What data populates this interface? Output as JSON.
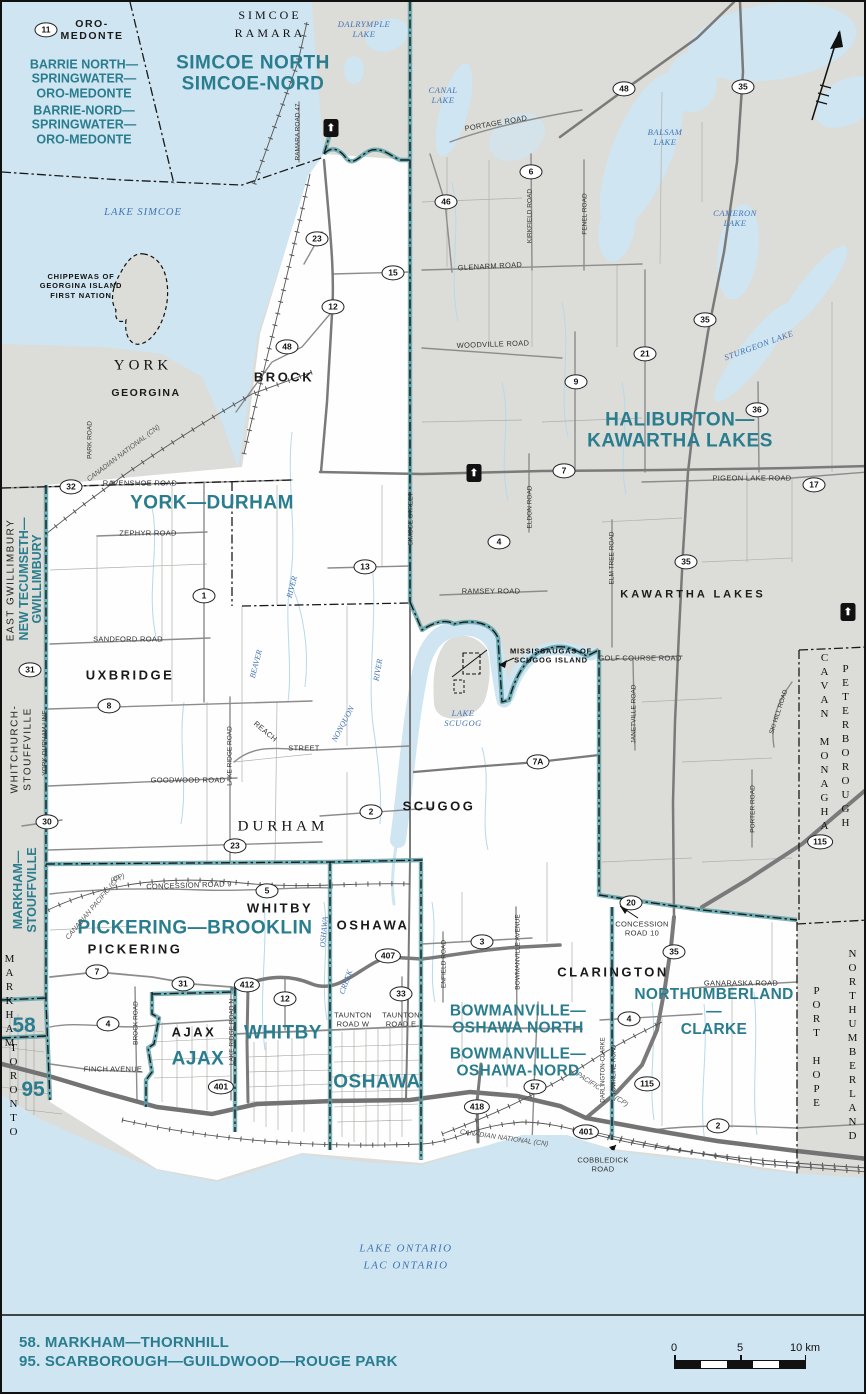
{
  "map": {
    "colors": {
      "water": "#cfe5f1",
      "other_district_gray": "#dcdcd8",
      "featured_white": "#fefefe",
      "riding_teal_text": "#2a7d8e",
      "boundary_teal": "#56a0a7",
      "water_label_blue": "#4273b3",
      "road_gray": "#8c8c8c",
      "boundary_black": "#1a1a1a"
    },
    "legend": {
      "items": [
        "58. MARKHAM—THORNHILL",
        "95. SCARBOROUGH—GUILDWOOD—ROUGE PARK"
      ]
    },
    "scale_bar": {
      "ticks": [
        "0",
        "5",
        "10 km"
      ]
    },
    "highway_marker_glyph": "⬆",
    "labels": [
      {
        "t": "ORO-\nMEDONTE",
        "x": 90,
        "y": 28,
        "c": "muni-sm"
      },
      {
        "t": "SIMCOE",
        "x": 268,
        "y": 14,
        "c": "serif-sm"
      },
      {
        "t": "RAMARA",
        "x": 268,
        "y": 32,
        "c": "serif-sm"
      },
      {
        "t": "BARRIE NORTH—\nSPRINGWATER—\nORO-MEDONTE",
        "x": 82,
        "y": 77,
        "c": "r3",
        "name": "riding-label-barrie-north-springwater-oro-medonte"
      },
      {
        "t": "BARRIE-NORD—\nSPRINGWATER—\nORO-MEDONTE",
        "x": 82,
        "y": 123,
        "c": "r3",
        "name": "riding-label-barrie-nord-springwater-oro-medonte"
      },
      {
        "t": "SIMCOE NORTH\nSIMCOE-NORD",
        "x": 251,
        "y": 72,
        "c": "r1",
        "name": "riding-label-simcoe-north"
      },
      {
        "t": "LAKE SIMCOE",
        "x": 141,
        "y": 211,
        "c": "water"
      },
      {
        "t": "DALRYMPLE\nLAKE",
        "x": 362,
        "y": 28,
        "c": "water-sm"
      },
      {
        "t": "CANAL\nLAKE",
        "x": 441,
        "y": 94,
        "c": "water-sm"
      },
      {
        "t": "BALSAM\nLAKE",
        "x": 663,
        "y": 136,
        "c": "water-sm"
      },
      {
        "t": "CAMERON\nLAKE",
        "x": 733,
        "y": 217,
        "c": "water-sm"
      },
      {
        "t": "STURGEON LAKE",
        "x": 757,
        "y": 344,
        "c": "water-sm",
        "r": -20
      },
      {
        "t": "CHIPPEWAS OF\nGEORGINA ISLAND\nFIRST NATION",
        "x": 79,
        "y": 284,
        "c": "fn",
        "name": "first-nation-label-chippewas"
      },
      {
        "t": "YORK",
        "x": 141,
        "y": 364,
        "c": "serif"
      },
      {
        "t": "GEORGINA",
        "x": 144,
        "y": 391,
        "c": "muni-sm"
      },
      {
        "t": "BROCK",
        "x": 282,
        "y": 376,
        "c": "muni"
      },
      {
        "t": "HALIBURTON—KAWARTHA LAKES",
        "x": 678,
        "y": 429,
        "c": "r1",
        "name": "riding-label-haliburton-kawartha-lakes"
      },
      {
        "t": "YORK—DURHAM",
        "x": 210,
        "y": 502,
        "c": "r1",
        "name": "riding-label-york-durham"
      },
      {
        "t": "KAWARTHA LAKES",
        "x": 691,
        "y": 593,
        "c": "muni-sp"
      },
      {
        "t": "UXBRIDGE",
        "x": 128,
        "y": 674,
        "c": "muni"
      },
      {
        "t": "DURHAM",
        "x": 281,
        "y": 825,
        "c": "serif"
      },
      {
        "t": "SCUGOG",
        "x": 437,
        "y": 805,
        "c": "muni"
      },
      {
        "t": "LAKE\nSCUGOG",
        "x": 461,
        "y": 717,
        "c": "water-sm"
      },
      {
        "t": "MISSISSAUGAS OF\nSCUGOG ISLAND",
        "x": 549,
        "y": 654,
        "c": "fn",
        "name": "first-nation-label-mississaugas"
      },
      {
        "t": "EAST GWILLIMBURY",
        "x": 9,
        "y": 578,
        "c": "sans-v",
        "r": -90
      },
      {
        "t": "NEW TECUMSETH—",
        "x": 22,
        "y": 577,
        "c": "r3",
        "r": -90,
        "name": "riding-label-new-tecumseth-gwillimbury"
      },
      {
        "t": "GWILLIMBURY",
        "x": 35,
        "y": 577,
        "c": "r3",
        "r": -90,
        "name": "riding-label-new-tecumseth-gwillimbury-2"
      },
      {
        "t": "WHITCHURCH-",
        "x": 13,
        "y": 747,
        "c": "sans-v",
        "r": -90
      },
      {
        "t": "STOUFFVILLE",
        "x": 26,
        "y": 747,
        "c": "sans-v",
        "r": -90
      },
      {
        "t": "MARKHAM—",
        "x": 16,
        "y": 888,
        "c": "r3",
        "r": -90,
        "name": "riding-label-markham-stouffville"
      },
      {
        "t": "STOUFFVILLE",
        "x": 30,
        "y": 888,
        "c": "r3",
        "r": -90,
        "name": "riding-label-markham-stouffville-2"
      },
      {
        "t": "PETERBOROUGH",
        "x": 843,
        "y": 745,
        "c": "serif-vu"
      },
      {
        "t": "CAVAN MONAGHAN",
        "x": 822,
        "y": 748,
        "c": "serif-vu"
      },
      {
        "t": "NORTHUMBERLAND",
        "x": 850,
        "y": 1044,
        "c": "serif-vu"
      },
      {
        "t": "PORT HOPE",
        "x": 814,
        "y": 1046,
        "c": "serif-vu"
      },
      {
        "t": "TORONTO",
        "x": 11,
        "y": 1089,
        "c": "serif-vu"
      },
      {
        "t": "MARKHAM",
        "x": 7,
        "y": 1000,
        "c": "serif-vu"
      },
      {
        "t": "PICKERING—BROOKLIN",
        "x": 193,
        "y": 927,
        "c": "r1",
        "name": "riding-label-pickering-brooklin"
      },
      {
        "t": "PICKERING",
        "x": 133,
        "y": 948,
        "c": "muni"
      },
      {
        "t": "WHITBY",
        "x": 278,
        "y": 907,
        "c": "muni"
      },
      {
        "t": "OSHAWA",
        "x": 371,
        "y": 924,
        "c": "muni"
      },
      {
        "t": "CLARINGTON",
        "x": 611,
        "y": 971,
        "c": "muni"
      },
      {
        "t": "AJAX",
        "x": 192,
        "y": 1031,
        "c": "muni"
      },
      {
        "t": "WHITBY",
        "x": 281,
        "y": 1032,
        "c": "r1",
        "name": "riding-label-whitby"
      },
      {
        "t": "AJAX",
        "x": 196,
        "y": 1058,
        "c": "r1",
        "name": "riding-label-ajax"
      },
      {
        "t": "OSHAWA",
        "x": 375,
        "y": 1081,
        "c": "r1",
        "name": "riding-label-oshawa"
      },
      {
        "t": "BOWMANVILLE—\nOSHAWA NORTH",
        "x": 516,
        "y": 1018,
        "c": "r2",
        "name": "riding-label-bowmanville-oshawa-north"
      },
      {
        "t": "BOWMANVILLE—\nOSHAWA-NORD",
        "x": 516,
        "y": 1061,
        "c": "r2",
        "name": "riding-label-bowmanville-oshawa-nord"
      },
      {
        "t": "NORTHUMBERLAND—\nCLARKE",
        "x": 712,
        "y": 1010,
        "c": "r2",
        "name": "riding-label-northumberland-clarke"
      },
      {
        "t": "58",
        "x": 22,
        "y": 1024,
        "c": "tealnum",
        "name": "riding-number-58"
      },
      {
        "t": "95",
        "x": 31,
        "y": 1088,
        "c": "tealnum",
        "name": "riding-number-95"
      },
      {
        "t": "LAKE ONTARIO\nLAC ONTARIO",
        "x": 404,
        "y": 1255,
        "c": "water-lg"
      },
      {
        "t": "PORTAGE ROAD",
        "x": 494,
        "y": 122,
        "c": "road",
        "r": -10
      },
      {
        "t": "RAMARA ROAD 47",
        "x": 296,
        "y": 130,
        "c": "road-xs",
        "r": -90
      },
      {
        "t": "GLENARM ROAD",
        "x": 488,
        "y": 265,
        "c": "road",
        "r": -3
      },
      {
        "t": "KIRKFIELD ROAD",
        "x": 528,
        "y": 214,
        "c": "road-xs",
        "r": -90
      },
      {
        "t": "FENEL ROAD",
        "x": 583,
        "y": 212,
        "c": "road-xs",
        "r": -90
      },
      {
        "t": "WOODVILLE ROAD",
        "x": 491,
        "y": 343,
        "c": "road",
        "r": -2
      },
      {
        "t": "RAVENSHOE ROAD",
        "x": 138,
        "y": 482,
        "c": "road"
      },
      {
        "t": "ZEPHYR ROAD",
        "x": 146,
        "y": 532,
        "c": "road"
      },
      {
        "t": "SANDFORD ROAD",
        "x": 126,
        "y": 638,
        "c": "road"
      },
      {
        "t": "GOODWOOD ROAD",
        "x": 186,
        "y": 779,
        "c": "road"
      },
      {
        "t": "REACH",
        "x": 263,
        "y": 730,
        "c": "road",
        "r": 40
      },
      {
        "t": "STREET",
        "x": 302,
        "y": 747,
        "c": "road"
      },
      {
        "t": "YORK-DURHAM LINE",
        "x": 43,
        "y": 741,
        "c": "road-xs",
        "r": -90
      },
      {
        "t": "LAKE RIDGE ROAD",
        "x": 228,
        "y": 754,
        "c": "road-xs",
        "r": -90
      },
      {
        "t": "SIMCOE STREET",
        "x": 409,
        "y": 517,
        "c": "road-xs",
        "r": -90
      },
      {
        "t": "ELDON ROAD",
        "x": 528,
        "y": 505,
        "c": "road-xs",
        "r": -90
      },
      {
        "t": "ELM TREE ROAD",
        "x": 610,
        "y": 556,
        "c": "road-xs",
        "r": -90
      },
      {
        "t": "PIGEON LAKE ROAD",
        "x": 750,
        "y": 477,
        "c": "road"
      },
      {
        "t": "RAMSEY ROAD",
        "x": 489,
        "y": 590,
        "c": "road"
      },
      {
        "t": "GOLF COURSE ROAD",
        "x": 638,
        "y": 657,
        "c": "road"
      },
      {
        "t": "JANETVILLE ROAD",
        "x": 632,
        "y": 712,
        "c": "road-xs",
        "r": -90
      },
      {
        "t": "SKI HILL ROAD",
        "x": 777,
        "y": 710,
        "c": "road-xs",
        "r": -72
      },
      {
        "t": "PORTER ROAD",
        "x": 751,
        "y": 807,
        "c": "road-xs",
        "r": -90
      },
      {
        "t": "GANARASKA ROAD",
        "x": 739,
        "y": 982,
        "c": "road"
      },
      {
        "t": "CONCESSION ROAD 9",
        "x": 187,
        "y": 884,
        "c": "road",
        "r": -2
      },
      {
        "t": "CONCESSION\nROAD 10",
        "x": 640,
        "y": 927,
        "c": "road"
      },
      {
        "t": "TAUNTON\nROAD W",
        "x": 351,
        "y": 1018,
        "c": "road"
      },
      {
        "t": "TAUNTON\nROAD E",
        "x": 399,
        "y": 1018,
        "c": "road"
      },
      {
        "t": "FINCH AVENUE",
        "x": 111,
        "y": 1068,
        "c": "road"
      },
      {
        "t": "BROCK ROAD",
        "x": 134,
        "y": 1021,
        "c": "road-xs",
        "r": -90
      },
      {
        "t": "LAKE RIDGE ROAD N",
        "x": 230,
        "y": 1030,
        "c": "road-xs",
        "r": -90
      },
      {
        "t": "ENFIELD ROAD",
        "x": 442,
        "y": 962,
        "c": "road-xs",
        "r": -90
      },
      {
        "t": "BOWMANVILLE AVENUE",
        "x": 516,
        "y": 950,
        "c": "road-xs",
        "r": -90
      },
      {
        "t": "DARLINGTON-CLARKE",
        "x": 602,
        "y": 1068,
        "c": "road-xxs",
        "r": -90
      },
      {
        "t": "TOWNLINE ROAD",
        "x": 613,
        "y": 1068,
        "c": "road-xxs",
        "r": -90
      },
      {
        "t": "COBBLEDICK\nROAD",
        "x": 601,
        "y": 1163,
        "c": "road"
      },
      {
        "t": "PARK ROAD",
        "x": 88,
        "y": 438,
        "c": "road-xs",
        "r": -90
      },
      {
        "t": "CANADIAN NATIONAL (CN)",
        "x": 122,
        "y": 452,
        "c": "rail",
        "r": -37
      },
      {
        "t": "CANADIAN PACIFIC (CP)",
        "x": 92,
        "y": 906,
        "c": "rail",
        "r": -50
      },
      {
        "t": "(CP)",
        "x": 116,
        "y": 877,
        "c": "rail",
        "r": -20
      },
      {
        "t": "CANADIAN NATIONAL (CN)",
        "x": 502,
        "y": 1137,
        "c": "rail",
        "r": 8
      },
      {
        "t": "PACIFIC",
        "x": 586,
        "y": 1080,
        "c": "rail",
        "r": 33
      },
      {
        "t": "(CP)",
        "x": 619,
        "y": 1100,
        "c": "rail",
        "r": 33
      },
      {
        "t": "RIVER",
        "x": 290,
        "y": 585,
        "c": "water-xs",
        "r": -75
      },
      {
        "t": "BEAVER",
        "x": 254,
        "y": 662,
        "c": "water-xs",
        "r": -75
      },
      {
        "t": "RIVER",
        "x": 376,
        "y": 668,
        "c": "water-xs",
        "r": -80
      },
      {
        "t": "NONQUON",
        "x": 341,
        "y": 722,
        "c": "water-xs",
        "r": -62
      },
      {
        "t": "OSHAWA",
        "x": 322,
        "y": 930,
        "c": "water-xs",
        "r": -85
      },
      {
        "t": "CREEK",
        "x": 344,
        "y": 980,
        "c": "water-xs",
        "r": -70
      }
    ],
    "shields": [
      {
        "n": "11",
        "x": 44,
        "y": 28
      },
      {
        "n": "48",
        "x": 622,
        "y": 87
      },
      {
        "n": "35",
        "x": 741,
        "y": 85
      },
      {
        "n": "6",
        "x": 529,
        "y": 170
      },
      {
        "n": "46",
        "x": 444,
        "y": 200
      },
      {
        "n": "23",
        "x": 315,
        "y": 237
      },
      {
        "n": "15",
        "x": 391,
        "y": 271
      },
      {
        "n": "12",
        "x": 331,
        "y": 305
      },
      {
        "n": "35",
        "x": 703,
        "y": 318
      },
      {
        "n": "48",
        "x": 285,
        "y": 345
      },
      {
        "n": "21",
        "x": 643,
        "y": 352
      },
      {
        "n": "9",
        "x": 574,
        "y": 380
      },
      {
        "n": "36",
        "x": 755,
        "y": 408
      },
      {
        "n": "7",
        "x": 562,
        "y": 469
      },
      {
        "n": "17",
        "x": 812,
        "y": 483
      },
      {
        "n": "32",
        "x": 69,
        "y": 485
      },
      {
        "n": "4",
        "x": 497,
        "y": 540
      },
      {
        "n": "35",
        "x": 684,
        "y": 560
      },
      {
        "n": "13",
        "x": 363,
        "y": 565
      },
      {
        "n": "1",
        "x": 202,
        "y": 594
      },
      {
        "n": "31",
        "x": 28,
        "y": 668
      },
      {
        "n": "8",
        "x": 107,
        "y": 704
      },
      {
        "n": "7A",
        "x": 536,
        "y": 760
      },
      {
        "n": "2",
        "x": 369,
        "y": 810
      },
      {
        "n": "30",
        "x": 45,
        "y": 820
      },
      {
        "n": "23",
        "x": 233,
        "y": 844
      },
      {
        "n": "5",
        "x": 265,
        "y": 889
      },
      {
        "n": "20",
        "x": 629,
        "y": 901
      },
      {
        "n": "3",
        "x": 480,
        "y": 940
      },
      {
        "n": "35",
        "x": 672,
        "y": 950
      },
      {
        "n": "407",
        "x": 386,
        "y": 954
      },
      {
        "n": "7",
        "x": 95,
        "y": 970
      },
      {
        "n": "31",
        "x": 181,
        "y": 982
      },
      {
        "n": "412",
        "x": 245,
        "y": 983
      },
      {
        "n": "33",
        "x": 399,
        "y": 992
      },
      {
        "n": "12",
        "x": 283,
        "y": 997
      },
      {
        "n": "4",
        "x": 627,
        "y": 1017
      },
      {
        "n": "4",
        "x": 106,
        "y": 1022
      },
      {
        "n": "115",
        "x": 645,
        "y": 1082
      },
      {
        "n": "57",
        "x": 533,
        "y": 1085
      },
      {
        "n": "401",
        "x": 219,
        "y": 1085
      },
      {
        "n": "418",
        "x": 475,
        "y": 1105
      },
      {
        "n": "2",
        "x": 716,
        "y": 1124
      },
      {
        "n": "401",
        "x": 584,
        "y": 1130
      },
      {
        "n": "115",
        "x": 818,
        "y": 840
      }
    ],
    "highway_markers": [
      {
        "x": 329,
        "y": 126
      },
      {
        "x": 472,
        "y": 471
      },
      {
        "x": 846,
        "y": 610
      }
    ]
  }
}
